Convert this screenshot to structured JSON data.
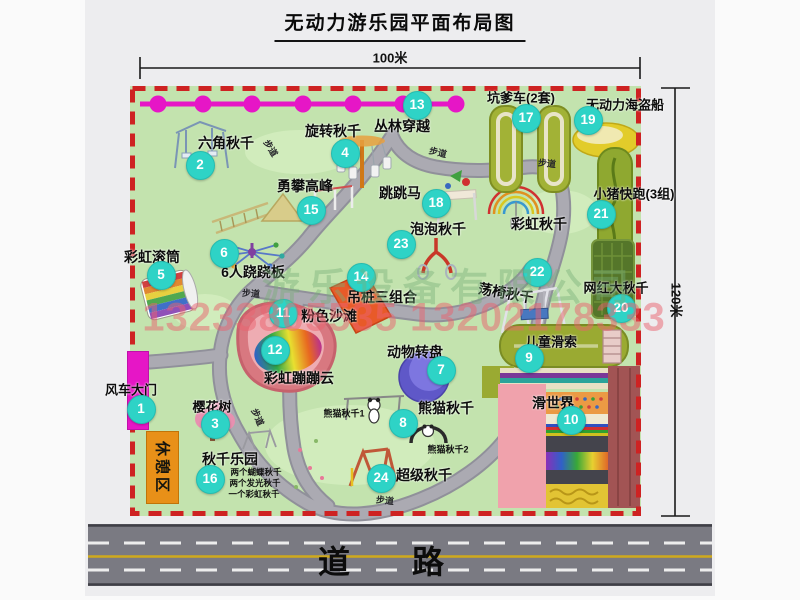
{
  "title": "无动力游乐园平面布局图",
  "dim_top": "100米",
  "dim_right": "120米",
  "road_label": "道路",
  "walkway": "步道",
  "rest_area": "休憩区",
  "rainbow_swing": "彩虹秋千",
  "watermark_company": "游乐设备有限公司",
  "watermark_phone": "13233805535 13202178333",
  "panda_swing_1": "熊猫秋千1",
  "panda_swing_2": "熊猫秋千2",
  "swing_park_items": [
    "两个蝴蝶秋千",
    "两个发光秋千",
    "一个彩虹秋千"
  ],
  "attractions": [
    {
      "num": "1",
      "name": "风车大门"
    },
    {
      "num": "2",
      "name": "六角秋千"
    },
    {
      "num": "3",
      "name": "樱花树"
    },
    {
      "num": "4",
      "name": "旋转秋千"
    },
    {
      "num": "5",
      "name": "彩虹滚筒"
    },
    {
      "num": "6",
      "name": "6人跷跷板"
    },
    {
      "num": "7",
      "name": "动物转盘"
    },
    {
      "num": "8",
      "name": "熊猫秋千"
    },
    {
      "num": "9",
      "name": "儿童滑索"
    },
    {
      "num": "10",
      "name": "滑世界"
    },
    {
      "num": "11",
      "name": "粉色沙滩"
    },
    {
      "num": "12",
      "name": "彩虹蹦蹦云"
    },
    {
      "num": "13",
      "name": "丛林穿越"
    },
    {
      "num": "14",
      "name": "吊桩三组合"
    },
    {
      "num": "15",
      "name": "勇攀高峰"
    },
    {
      "num": "16",
      "name": "秋千乐园"
    },
    {
      "num": "17",
      "name": "坑爹车(2套)"
    },
    {
      "num": "18",
      "name": "跳跳马"
    },
    {
      "num": "19",
      "name": "无动力海盗船"
    },
    {
      "num": "20",
      "name": "网红大秋千"
    },
    {
      "num": "21",
      "name": "小猪快跑(3组)"
    },
    {
      "num": "22",
      "name": "荡椅秋千"
    },
    {
      "num": "23",
      "name": "泡泡秋千"
    },
    {
      "num": "24",
      "name": "超级秋千"
    }
  ],
  "colors": {
    "badge": "#2ed3c6",
    "border_red": "#ce2222",
    "park_green": "#c3e3ae",
    "gate_magenta": "#e616c6"
  }
}
